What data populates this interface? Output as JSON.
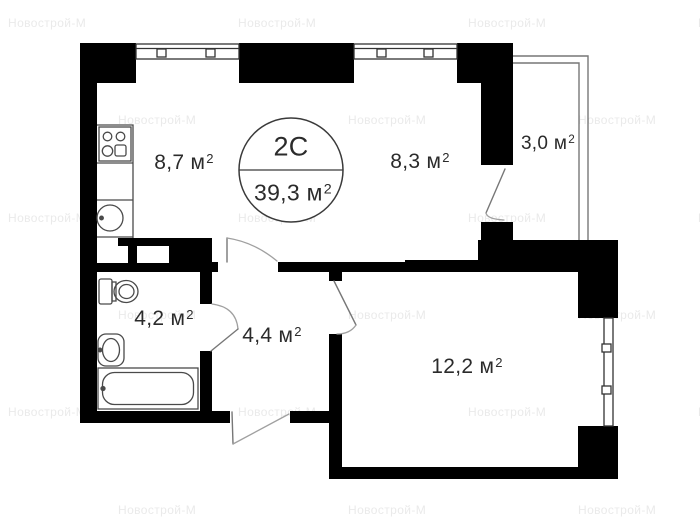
{
  "watermark": {
    "text": "Новострой-М"
  },
  "unit": {
    "type": "2С",
    "total_area": "39,3 м",
    "total_area_sup": "2"
  },
  "rooms": {
    "kitchen": {
      "name": "kitchen",
      "area": "8,7 м",
      "sup": "2"
    },
    "living": {
      "name": "living",
      "area": "8,3 м",
      "sup": "2"
    },
    "balcony": {
      "name": "balcony",
      "area": "3,0 м",
      "sup": "2"
    },
    "bathroom": {
      "name": "bathroom",
      "area": "4,2 м",
      "sup": "2"
    },
    "hallway": {
      "name": "hallway",
      "area": "4,4 м",
      "sup": "2"
    },
    "bedroom": {
      "name": "bedroom",
      "area": "12,2 м",
      "sup": "2"
    }
  },
  "colors": {
    "wall": "#000000",
    "fixture_line": "#4a4a4a",
    "door_line": "#999999",
    "label_text": "#2b2b2b",
    "watermark": "#eaeaea"
  }
}
